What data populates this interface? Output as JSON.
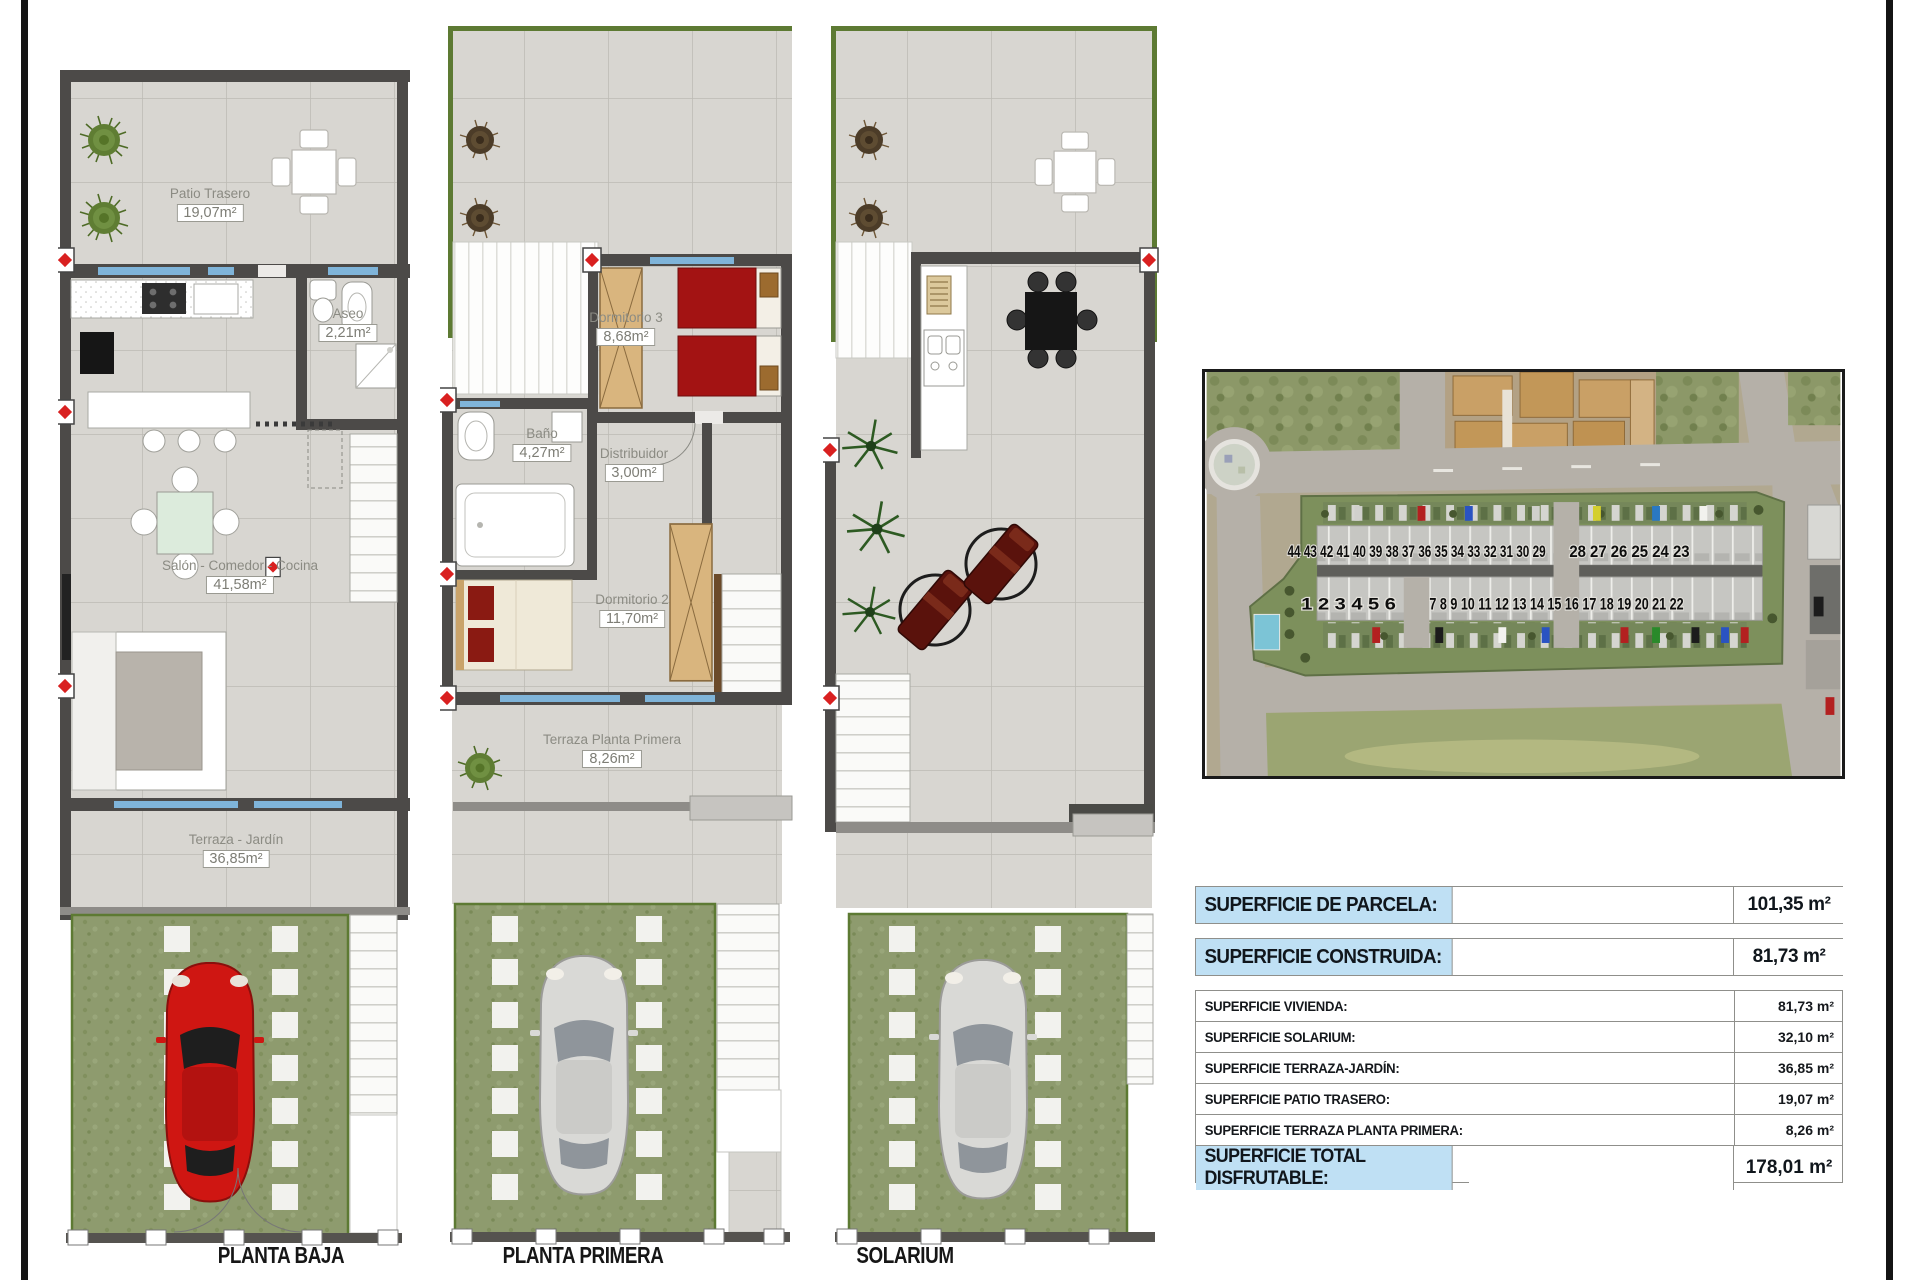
{
  "sheet": {
    "plans": [
      {
        "title": "PLANTA BAJA",
        "rooms": [
          {
            "name": "Patio Trasero",
            "area": "19,07m²"
          },
          {
            "name": "Aseo",
            "area": "2,21m²"
          },
          {
            "name": "Salón - Comedor - Cocina",
            "area": "41,58m²"
          },
          {
            "name": "Terraza - Jardín",
            "area": "36,85m²"
          }
        ]
      },
      {
        "title": "PLANTA PRIMERA",
        "rooms": [
          {
            "name": "Dormitorio 3",
            "area": "8,68m²"
          },
          {
            "name": "Baño",
            "area": "4,27m²"
          },
          {
            "name": "Distribuidor",
            "area": "3,00m²"
          },
          {
            "name": "Dormitorio 2",
            "area": "11,70m²"
          },
          {
            "name": "Terraza Planta Primera",
            "area": "8,26m²"
          }
        ]
      },
      {
        "title": "SOLARIUM",
        "rooms": []
      }
    ],
    "site_photo": {
      "units_row_back_left": "44 43 42 41 40 39 38 37 36 35 34 33 32 31 30 29",
      "units_row_back_right": "28 27 26 25 24 23",
      "units_row_front_left": "1 2 3 4 5 6",
      "units_row_front_right": "7 8 9 10 11 12 13 14 15 16 17 18 19 20 21 22"
    },
    "areas_table": {
      "parcela": {
        "label": "SUPERFICIE DE PARCELA:",
        "value": "101,35 m²"
      },
      "construida": {
        "label": "SUPERFICIE CONSTRUIDA:",
        "value": "81,73 m²"
      },
      "details": [
        {
          "label": "SUPERFICIE VIVIENDA:",
          "value": "81,73 m²"
        },
        {
          "label": "SUPERFICIE SOLARIUM:",
          "value": "32,10 m²"
        },
        {
          "label": "SUPERFICIE TERRAZA-JARDÍN:",
          "value": "36,85 m²"
        },
        {
          "label": "SUPERFICIE PATIO TRASERO:",
          "value": "19,07 m²"
        },
        {
          "label": "SUPERFICIE TERRAZA PLANTA PRIMERA:",
          "value": "8,26 m²"
        }
      ],
      "total": {
        "label": "SUPERFICIE TOTAL DISFRUTABLE:",
        "value": "178,01 m²"
      }
    },
    "colors": {
      "highlight_cell": "#bfe0f4",
      "plan_green_edge": "#5d7a33",
      "red_car": "#cf1612"
    }
  }
}
